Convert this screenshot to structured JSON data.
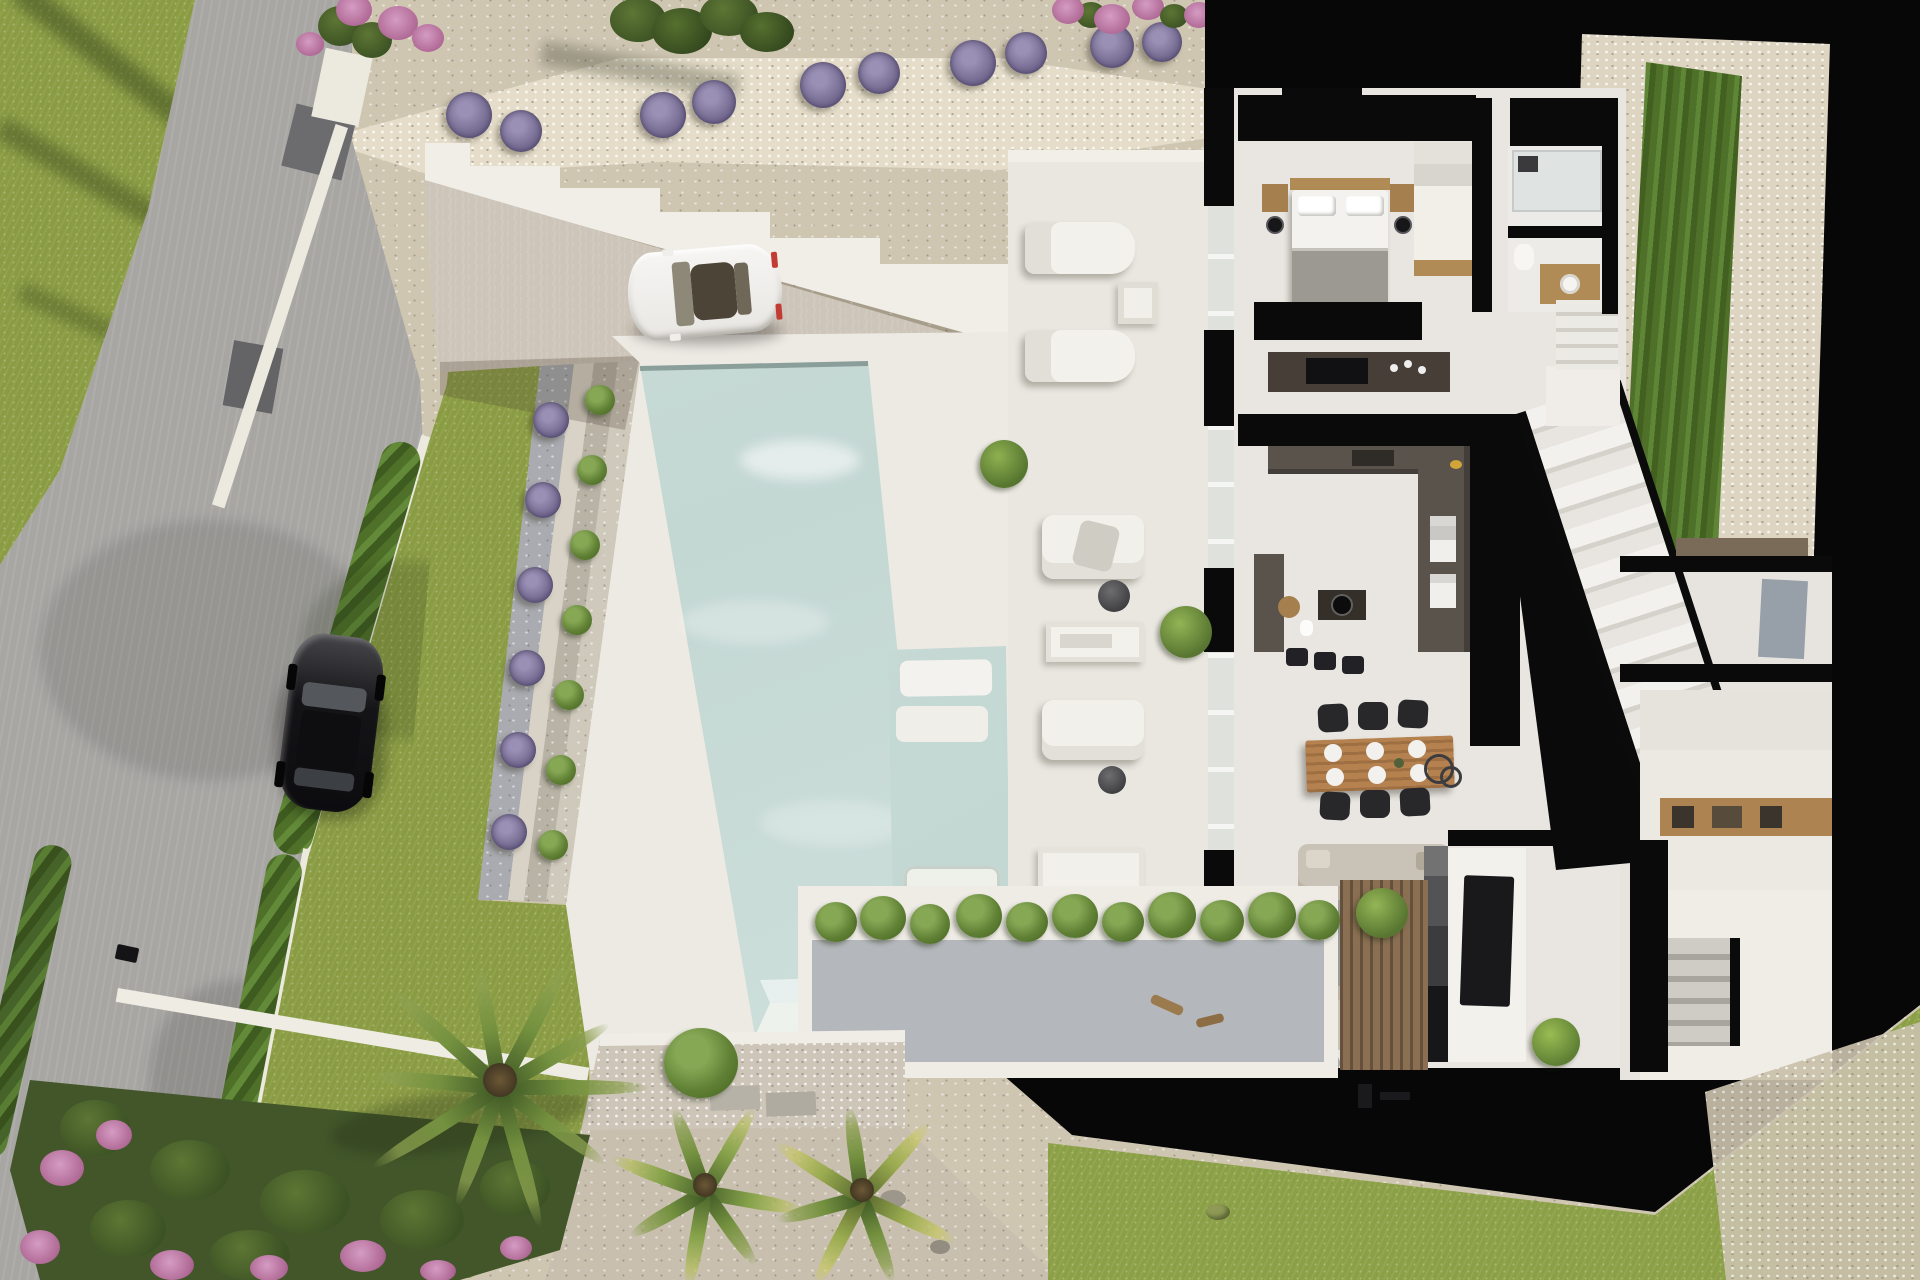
{
  "scene": {
    "label": "Aerial 3D architectural rendering of a modern villa with cutaway ground-floor plan, infinity pool, landscaped garden, driveway and two parked cars",
    "view": "top-down drone view, afternoon sunlight from upper-left",
    "visible_text": "none",
    "palette": {
      "grass": "#8a9c43",
      "road": "#a8a6a3",
      "gravel": "#d3c9b4",
      "pebble_path": "#e5ddc9",
      "pool_water": "#c6dad6",
      "deck_white": "#edeae4",
      "house_floor": "#e9e6e1",
      "cut_walls": "#0a0a0b",
      "wood": "#ad8352",
      "kitchen_counter": "#5a534c",
      "sofa": "#c9c2b6",
      "hedge": "#4f7029",
      "lavender": "#7b7096",
      "flowers_pink": "#b06a96",
      "white_car": "#f4f3f1",
      "black_car": "#1c1c1f"
    }
  },
  "objects": {
    "road": {
      "label": "asphalt road along the west side"
    },
    "driveway": {
      "label": "paved driveway in front of the villa"
    },
    "white_car": {
      "label": "white sports car parked on driveway"
    },
    "black_car": {
      "label": "black car parked on the road"
    },
    "main_pool": {
      "label": "large infinity swimming pool"
    },
    "kids_pool": {
      "label": "shallow secondary pool with submerged loungers",
      "in_pool_loungers": 3
    },
    "pool_terraces": {
      "label": "terraced planter steps with shrubs and lavender beside pool"
    },
    "sun_terrace": {
      "label": "white sun terrace",
      "sun_loungers": 2,
      "armchairs": 2,
      "daybeds": 2,
      "side_tables": 2,
      "poufs": 3,
      "console_tables": 1,
      "potted_plants": 2
    },
    "bedroom": {
      "label": "master bedroom",
      "bed": 1,
      "bedside_tables": 2,
      "wall_lamps": 2,
      "wardrobe_drawers": 1
    },
    "bathroom": {
      "label": "bathroom with walk-in shower and wood vanity"
    },
    "kitchen": {
      "label": "U-shaped dark kitchen",
      "bar_stools": 3,
      "ovens": 2,
      "island_hob": 1
    },
    "dining": {
      "label": "dining area",
      "chairs": 6,
      "place_settings": 6
    },
    "living": {
      "label": "living room",
      "sofas": 2,
      "double_fireplace": 1,
      "rug": 1,
      "tv": 1
    },
    "stairs": {
      "label": "main staircase to upper floor",
      "flights": 2
    },
    "hall_cabinets": {
      "label": "hallway cabinets with wood niche"
    },
    "storage": {
      "label": "storage / utility rooms on east side"
    },
    "hedge_left": {
      "label": "clipped hedge along west boundary wall"
    },
    "hedge_right": {
      "label": "clipped hedge along east boundary"
    },
    "lavender_row": {
      "label": "row of lavender bushes along upper path",
      "count": 12
    },
    "olive_tree": {
      "label": "olive tree on upper gravel bank"
    },
    "palm_trees": {
      "label": "palm trees in lower garden",
      "count": 3
    },
    "flower_bed": {
      "label": "pink flowering shrubs in lower-left garden"
    },
    "planter": {
      "label": "gravel planter with hedge row below the house"
    },
    "lawn": {
      "label": "villa lawn"
    },
    "stepped_walls": {
      "label": "white stepped retaining walls above driveway"
    }
  }
}
